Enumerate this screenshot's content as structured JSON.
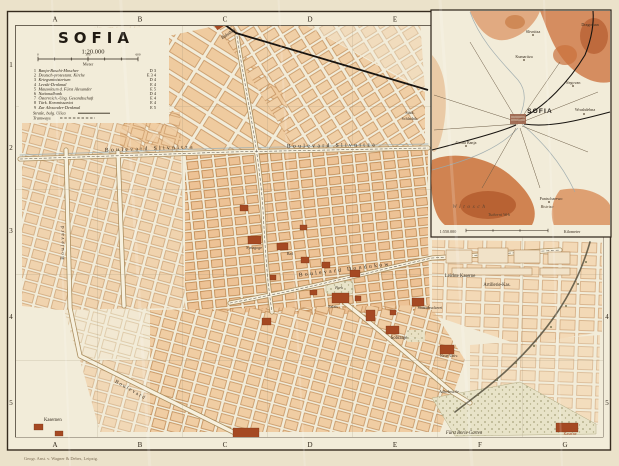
{
  "colors": {
    "paper-out": "#ebe2ca",
    "paper": "#f2ecd9",
    "block": "#efcda3",
    "block-dark": "#edc295",
    "building": "#a54923",
    "outline": "#c08c58",
    "frame": "#352b1e",
    "mountain": "#cd7a45",
    "railway": "#181410"
  },
  "frame": {
    "letters_top": [
      "A",
      "B",
      "C",
      "D",
      "E",
      "F",
      "G"
    ],
    "letters_bottom": [
      "A",
      "B",
      "C",
      "D",
      "E",
      "F",
      "G"
    ],
    "numbers_left": [
      "1",
      "2",
      "3",
      "4",
      "5"
    ],
    "numbers_right": [
      "1",
      "2",
      "3",
      "4",
      "5"
    ],
    "imprint": "Geogr. Anst. v. Wagner & Debes, Leipzig."
  },
  "title_block": {
    "title": "SOFIA",
    "scale": "1:20.000",
    "scale_unit": "Meter",
    "scale_ticks": [
      "0",
      "300",
      "600"
    ],
    "legend": {
      "items": [
        {
          "num": "1",
          "label": "Banja-Baschi-Moschee",
          "ref": "D 3"
        },
        {
          "num": "2",
          "label": "Deutsch-protestant. Kirche",
          "ref": "E 3 4"
        },
        {
          "num": "3",
          "label": "Kriegsministerium",
          "ref": "D 4"
        },
        {
          "num": "4",
          "label": "Levski-Denkmal",
          "ref": "E 4"
        },
        {
          "num": "5",
          "label": "Mausoleum d. Fürst Alexander",
          "ref": "E 5"
        },
        {
          "num": "6",
          "label": "Nationalbank",
          "ref": "D 4"
        },
        {
          "num": "7",
          "label": "Österreich.-Ung. Gesandtschaft",
          "ref": "E 4"
        },
        {
          "num": "8",
          "label": "Türk. Kommissariat",
          "ref": "E 4"
        },
        {
          "num": "9",
          "label": "Zar Alexander-Denkmal",
          "ref": "E 5"
        }
      ],
      "note_street": "Straße, bulg. Ulica",
      "note_tram": "Tramways"
    }
  },
  "map": {
    "labels": {
      "radomir": "Radomir",
      "plevna": "Plevna",
      "bahnhof": "Bahnhof",
      "slivnitza1": "Boulevard Slivnitza",
      "slivnitza2": "Boulevard Slivnitza",
      "dondukow": "Boulevard Dondukow",
      "boulevard_w": "Boulevard",
      "boulevard_sw": "Boulevard",
      "staedt1": "Städt.",
      "staedt2": "Schlachth.",
      "synagoge": "Synagoge",
      "bad": "Bad",
      "park": "Park",
      "palais": "Palais",
      "sobranje": "Sobranje",
      "staatsdruckerei": "Staatsdruckerei",
      "neue_univ": "Neue Univ.",
      "leichte_kaserne": "Leichte Kaserne",
      "artillerie_kas": "Artillerie-Kas.",
      "kasernen": "Kasernen",
      "infant_kaserne": "Infant.-Kaserne",
      "kavallerie1": "Kavallerie-",
      "kavallerie2": "Kaserne",
      "boris_garten": "Fürst Boris-Garten",
      "adlerbruecke": "Adlerbrücke",
      "knjashevo": "Knjashevo"
    }
  },
  "inset": {
    "labels": {
      "sofia": "SOFIA",
      "dragoman": "Dragoman",
      "slivnitza": "Slivnitza",
      "kumaritza": "Kumaritza",
      "negovan": "Negovan",
      "wrashdebna": "Wrashdebna",
      "gorna_banja": "Gorna Banja",
      "pantscharewo": "Pantscharewo",
      "bistriza": "Bistriza",
      "witosch": "Witosch",
      "tscherni_wrh": "Tscherni Wrh"
    },
    "scale": "1:550.000",
    "scale_unit": "Kilometer"
  }
}
